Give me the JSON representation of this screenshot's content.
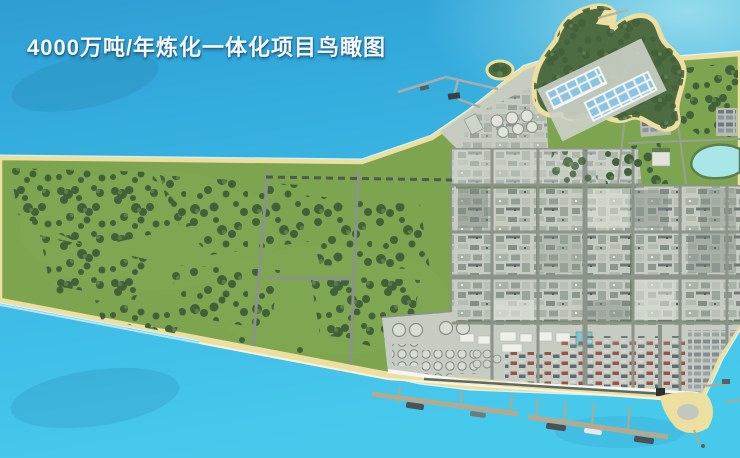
{
  "title": "4000万吨/年炼化一体化项目鸟瞰图",
  "scene_label": "炼化一体化项目鸟瞰图",
  "colors": {
    "water_deep": "#2e9ed4",
    "water_mid": "#38b4e2",
    "water_bright": "#47c9ec",
    "water_pale": "#96dcec",
    "lagoon": "#a8e6e8",
    "sand": "#ecdf9f",
    "sand_light": "#f4ecc0",
    "grass": "#7da54f",
    "grass_light": "#88ae5a",
    "forest": "#42603a",
    "forest_light": "#5d7f49",
    "industrial": "#c6ccc2",
    "industrial_dark": "#8d988f",
    "road": "#8b938a",
    "road_dark": "#5f6a62",
    "seawall": "#f4f7f1",
    "pier": "#b5aa90",
    "ship_dark": "#4a5258",
    "white_building": "#eef0ea",
    "pond_blue": "#8cc2e2",
    "title_color": "#f5f9fc"
  }
}
